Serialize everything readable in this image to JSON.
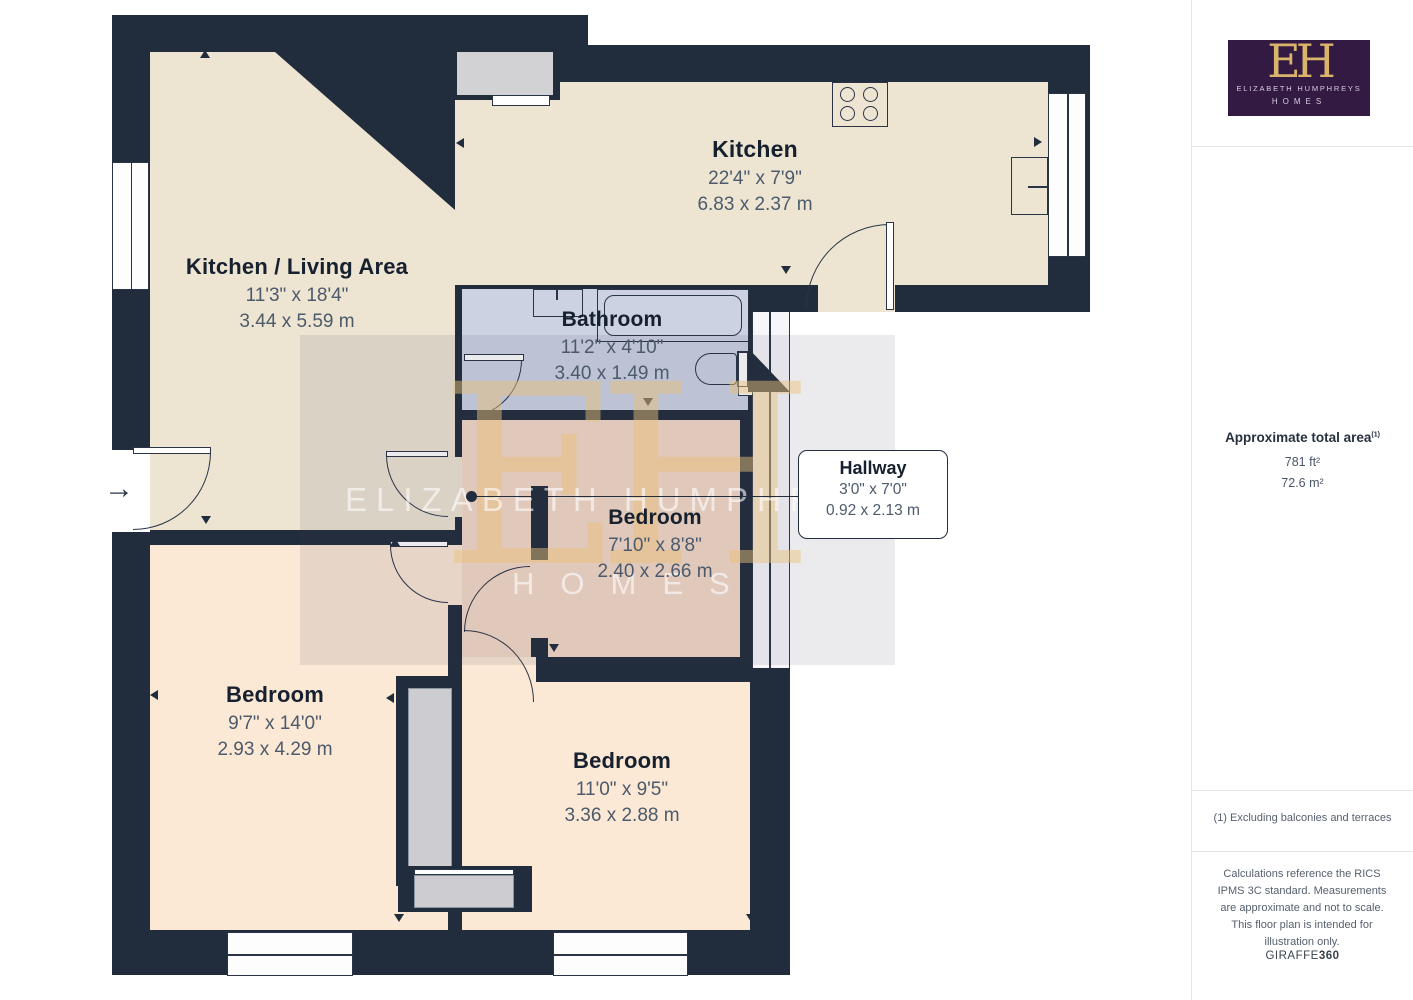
{
  "plan": {
    "rooms": {
      "kitchen": {
        "name": "Kitchen",
        "dims_ft": "22'4\" x 7'9\"",
        "dims_m": "6.83 x 2.37 m"
      },
      "kitchen_living": {
        "name": "Kitchen / Living Area",
        "dims_ft": "11'3\" x 18'4\"",
        "dims_m": "3.44 x 5.59 m"
      },
      "bathroom": {
        "name": "Bathroom",
        "dims_ft": "11'2\" x 4'10\"",
        "dims_m": "3.40 x 1.49 m"
      },
      "hallway": {
        "name": "Hallway",
        "dims_ft": "3'0\" x 7'0\"",
        "dims_m": "0.92 x 2.13 m"
      },
      "bedroom_middle": {
        "name": "Bedroom",
        "dims_ft": "7'10\" x 8'8\"",
        "dims_m": "2.40 x 2.66 m"
      },
      "bedroom_left": {
        "name": "Bedroom",
        "dims_ft": "9'7\" x 14'0\"",
        "dims_m": "2.93 x 4.29 m"
      },
      "bedroom_right": {
        "name": "Bedroom",
        "dims_ft": "11'0\" x 9'5\"",
        "dims_m": "3.36 x 2.88 m"
      }
    },
    "entry_arrow": "→"
  },
  "watermark": {
    "initials": "EH",
    "line1": "ELIZABETH HUMPHREYS",
    "line2": "HOMES"
  },
  "sidebar": {
    "logo": {
      "initials": "EH",
      "line1": "ELIZABETH HUMPHREYS",
      "line2": "HOMES"
    },
    "area": {
      "title": "Approximate total area",
      "footnote_ref": "(1)",
      "value_imperial": "781 ft²",
      "value_metric": "72.6 m²"
    },
    "footnote": "(1) Excluding balconies and terraces",
    "disclaimer": "Calculations reference the RICS IPMS 3C standard. Measurements are approximate and not to scale. This floor plan is intended for illustration only.",
    "brand": {
      "name": "GIRAFFE",
      "suffix": "360"
    }
  },
  "colors": {
    "wall": "#212C3C",
    "cream": "#EDE5D2",
    "bathroom": "#CCD2E2",
    "bedroom_pink": "#F3D9C7",
    "bedroom_peach": "#FBE8D5",
    "closet_gray": "#CDCDD1",
    "logo_purple": "#321A42",
    "logo_gold": "#D9B46B"
  }
}
